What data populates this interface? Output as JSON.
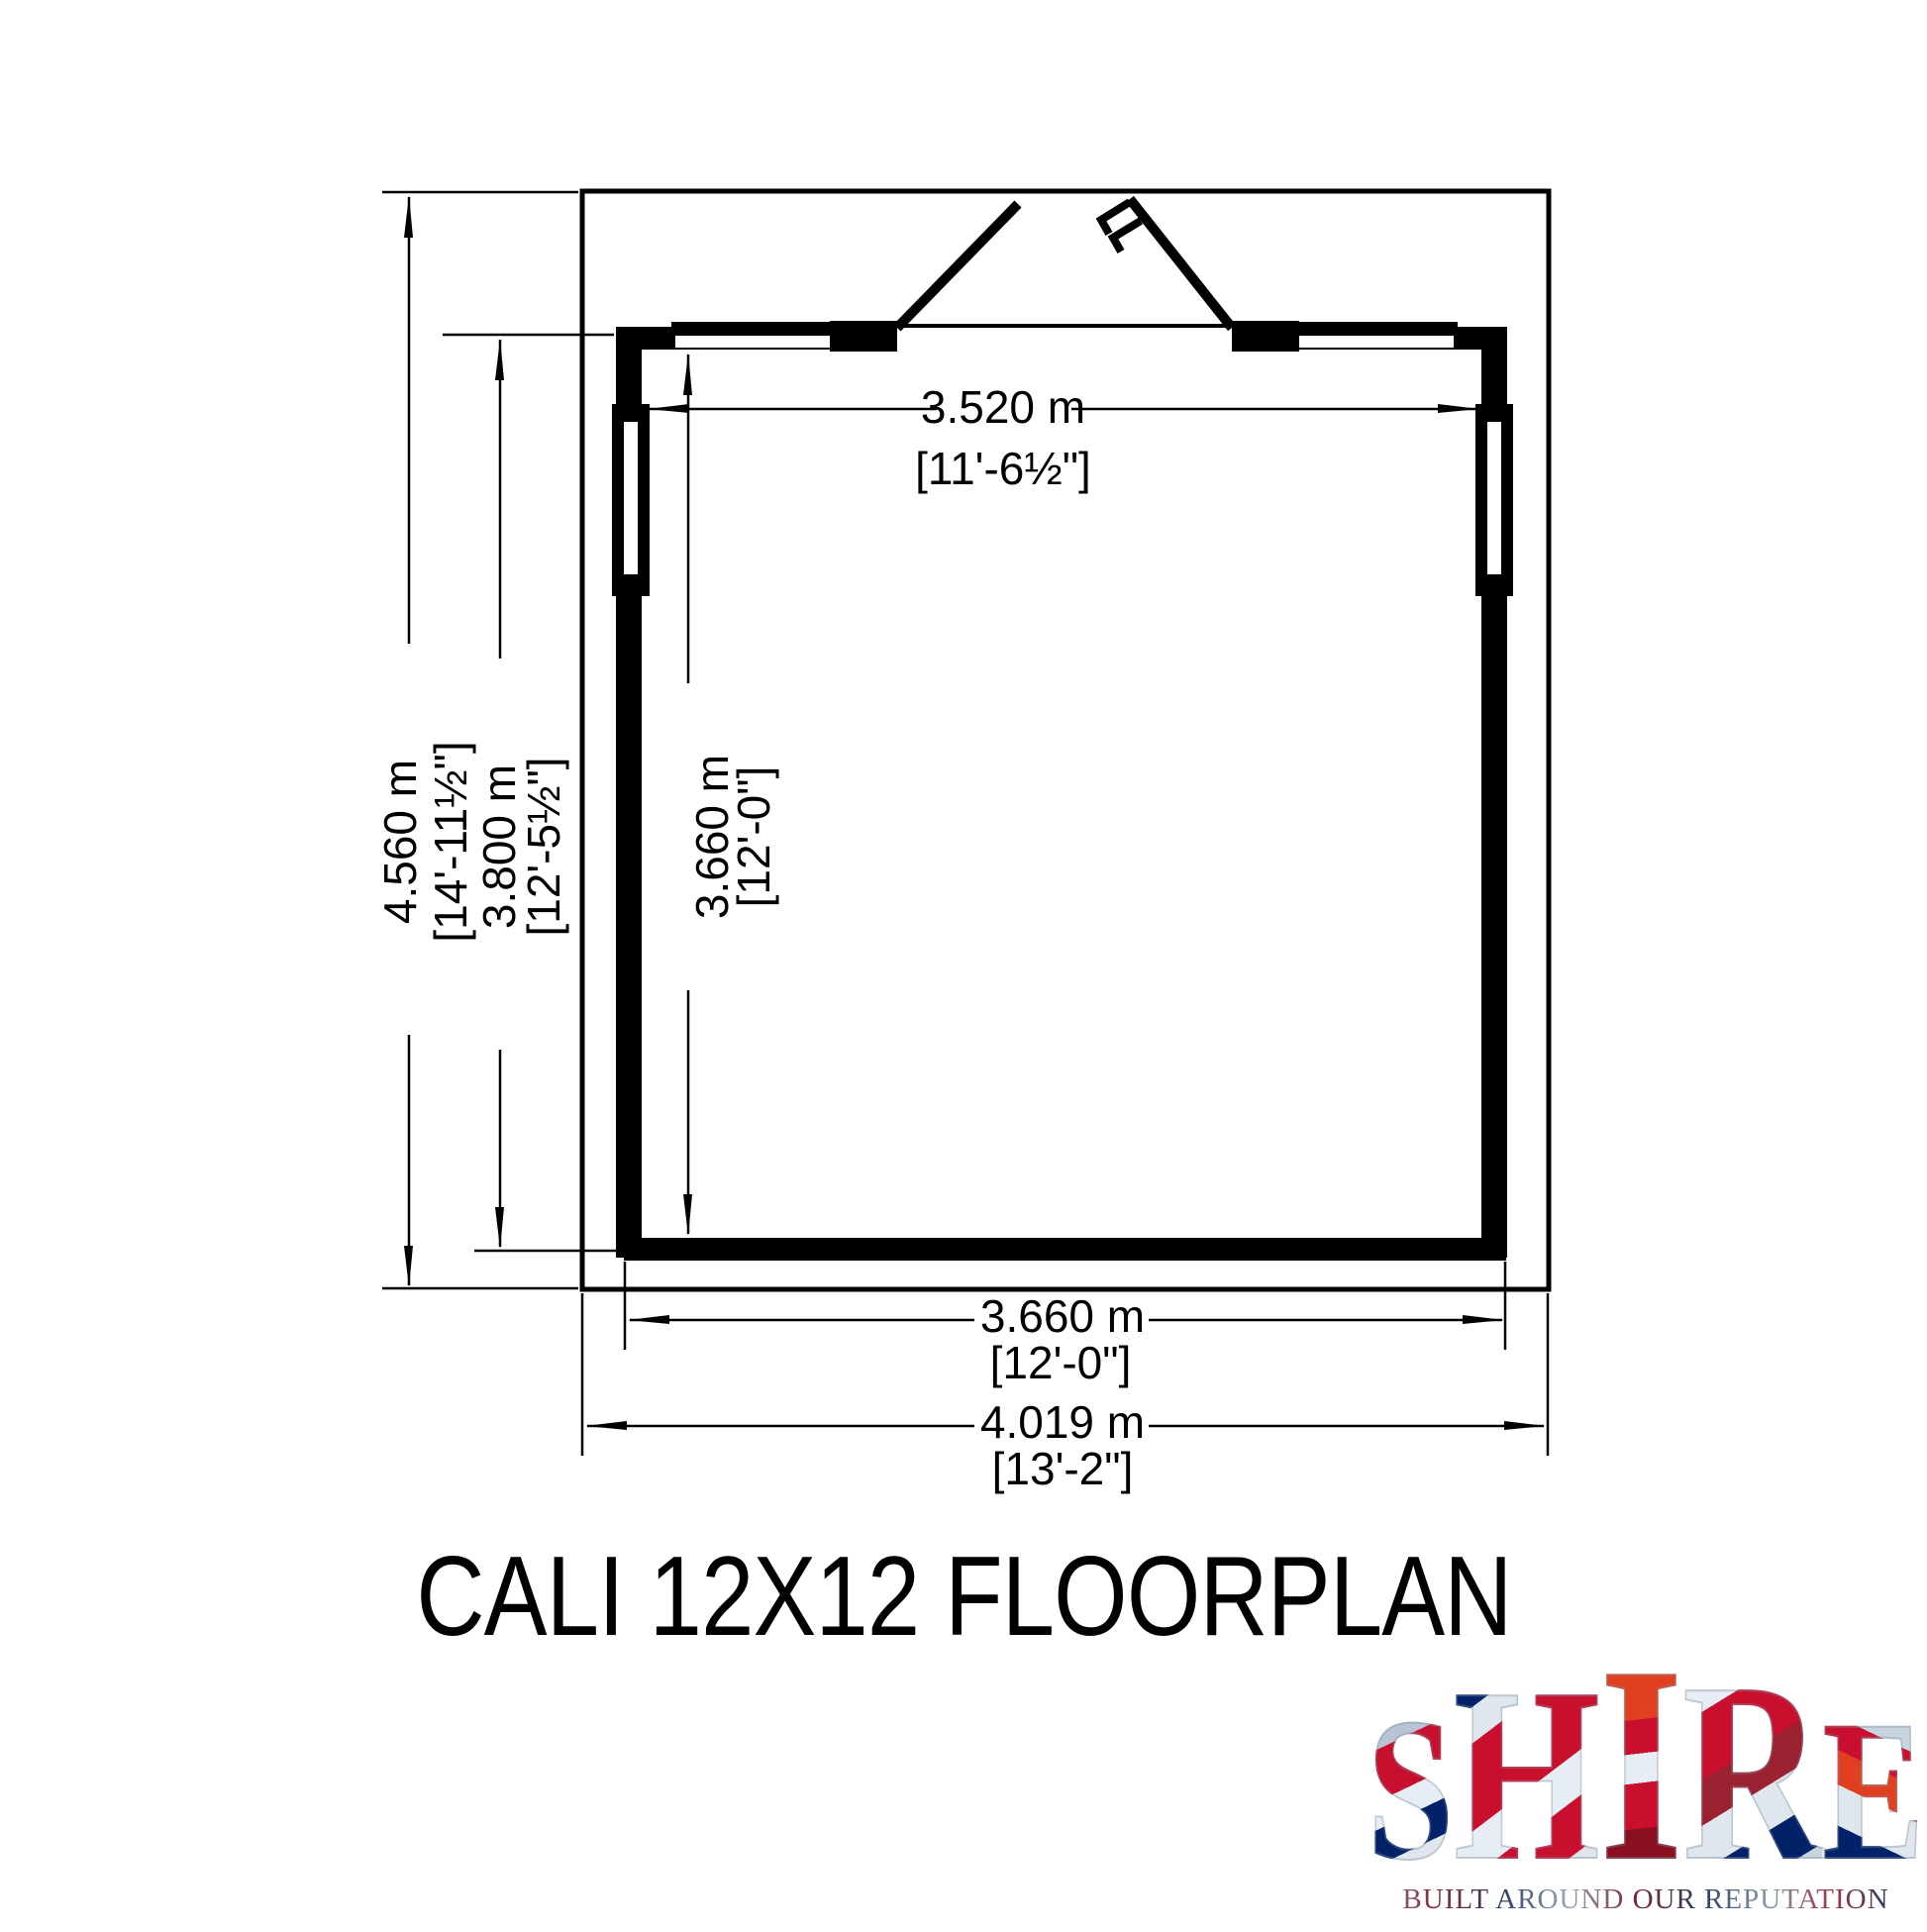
{
  "title": "CALI 12X12 FLOORPLAN",
  "dimensions": {
    "overall_depth": {
      "metric": "4.560 m",
      "imperial": "[14'-11½\"]"
    },
    "building_depth": {
      "metric": "3.800 m",
      "imperial": "[12'-5½\"]"
    },
    "interior_depth": {
      "metric": "3.660 m",
      "imperial": "[12'-0\"]"
    },
    "interior_width": {
      "metric": "3.520 m",
      "imperial": "[11'-6½\"]"
    },
    "floor_width": {
      "metric": "3.660 m",
      "imperial": "[12'-0\"]"
    },
    "overall_width": {
      "metric": "4.019 m",
      "imperial": "[13'-2\"]"
    }
  },
  "logo": {
    "letters": [
      "S",
      "H",
      "I",
      "R",
      "E"
    ],
    "tagline": "BUILT AROUND OUR REPUTATION"
  },
  "colors": {
    "line": "#000000",
    "background": "#ffffff",
    "flag_red": "#c8102e",
    "flag_blue": "#012169",
    "flag_silver": "#dfe6ee"
  }
}
